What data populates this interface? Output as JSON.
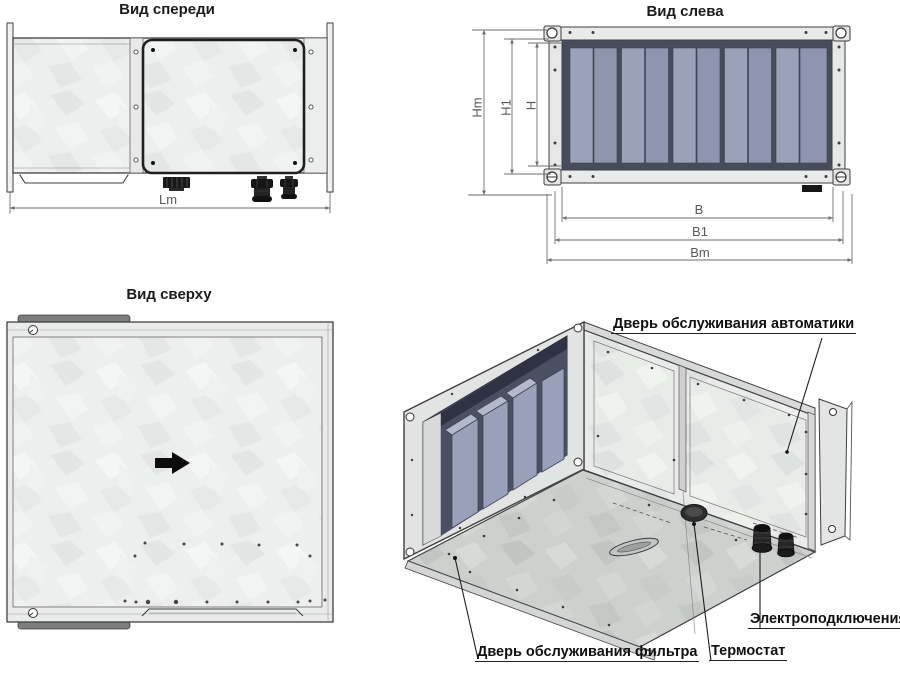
{
  "views": {
    "front": {
      "title": "Вид спереди",
      "dim_labels": {
        "lm": "Lm"
      }
    },
    "left": {
      "title": "Вид слева",
      "dim_labels": {
        "hm": "Hm",
        "h1": "H1",
        "h": "H",
        "b": "B",
        "b1": "B1",
        "bm": "Bm"
      }
    },
    "top": {
      "title": "Вид сверху",
      "flow_arrow_icon": "black right-pointing flow arrow"
    },
    "iso": {
      "callouts": {
        "automation_door": "Дверь обслуживания автоматики",
        "filter_door": "Дверь обслуживания фильтра",
        "thermostat": "Термостат",
        "electrical": "Электроподключения"
      }
    }
  },
  "colors": {
    "outline": "#3f3f3f",
    "dimension_line": "#6e6e6e",
    "dimension_text": "#585858",
    "title_text": "#1b1b1b",
    "galvanized_panel": "#edefee",
    "dark_opening": "#474c5c",
    "slat_light": "#9ba1b9",
    "slat_dark": "#8f95ae",
    "floor_panel": "#cdd1ce",
    "black_detail": "#1a1a1a"
  }
}
